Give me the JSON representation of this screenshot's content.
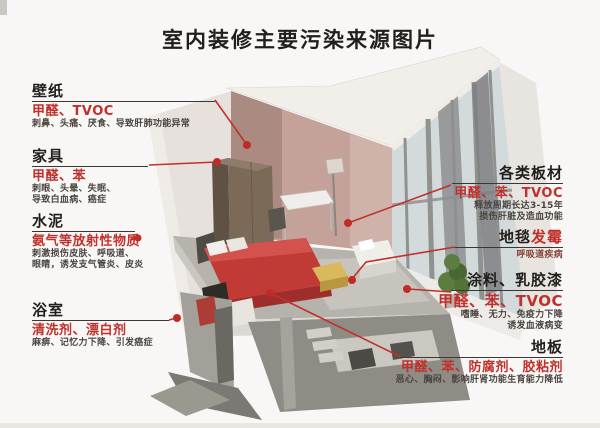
{
  "title": "室内装修主要污染来源图片",
  "colors": {
    "accent_red": "#c1302c",
    "header_text": "#211e1b",
    "effect_text": "#4a4440",
    "background": "#f8f7f5",
    "wall_pink": "#c4a29a",
    "floor_gray": "#b6b3ad",
    "bed_red": "#c23a36"
  },
  "sections": {
    "wallpaper": {
      "title": "壁纸",
      "pollutants": "甲醛、TVOC",
      "effect1": "刺鼻、头痛、厌食、导致肝肺功能异常"
    },
    "furniture": {
      "title": "家具",
      "pollutants": "甲醛、苯",
      "effect1": "刺眼、头晕、失眠、",
      "effect2": "导致白血病、癌症"
    },
    "cement": {
      "title": "水泥",
      "pollutants": "氨气等放射性物质",
      "effect1": "刺激损伤皮肤、呼吸道、",
      "effect2": "眼睛，诱发支气管炎、皮炎"
    },
    "bathroom": {
      "title": "浴室",
      "pollutants": "清洗剂、漂白剂",
      "effect1": "麻痹、记忆力下降、引发癌症"
    },
    "boards": {
      "title": "各类板材",
      "pollutants": "甲醛、苯、TVOC",
      "effect1": "释放周期长达3-15年",
      "effect2": "损伤肝脏及造血功能"
    },
    "carpet": {
      "title_black": "地毯",
      "title_red": "发霉",
      "effect1": "呼吸道疾病"
    },
    "paint": {
      "title": "涂料、乳胶漆",
      "pollutants": "甲醛、苯、TVOC",
      "effect1": "嗜睡、无力、免疫力下降",
      "effect2": "诱发血液病变"
    },
    "floor": {
      "title": "地板",
      "pollutants": "甲醛、苯、防腐剂、胶粘剂",
      "effect1": "恶心、胸闷、影响肝肾功能生育能力降低"
    }
  }
}
